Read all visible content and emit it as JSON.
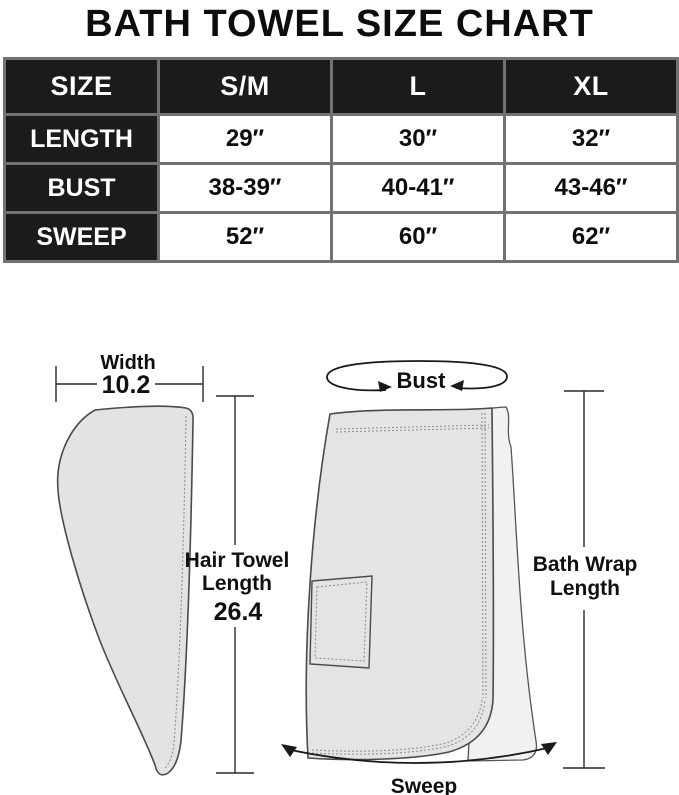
{
  "title": "BATH TOWEL SIZE CHART",
  "chart_data": {
    "type": "table",
    "title": "BATH TOWEL SIZE CHART",
    "columns": [
      "SIZE",
      "S/M",
      "L",
      "XL"
    ],
    "rows": [
      {
        "label": "LENGTH",
        "values": [
          "29″",
          "30″",
          "32″"
        ]
      },
      {
        "label": "BUST",
        "values": [
          "38-39″",
          "40-41″",
          "43-46″"
        ]
      },
      {
        "label": "SWEEP",
        "values": [
          "52″",
          "60″",
          "62″"
        ]
      }
    ]
  },
  "diagram": {
    "hair_towel": {
      "width_label": "Width",
      "width_value": "10.2",
      "length_label": [
        "Hair Towel",
        "Length"
      ],
      "length_value": "26.4"
    },
    "bath_wrap": {
      "bust_label": "Bust",
      "length_label": [
        "Bath Wrap",
        "Length"
      ],
      "sweep_label": "Sweep"
    }
  },
  "colors": {
    "header_bg": "#1b1b1b",
    "header_text": "#ffffff",
    "table_border": "#727272",
    "towel_fill": "#e3e3e3",
    "flap_fill": "#f1f1f1",
    "outline": "#4a4a4a",
    "arrow": "#1a1a1a"
  }
}
